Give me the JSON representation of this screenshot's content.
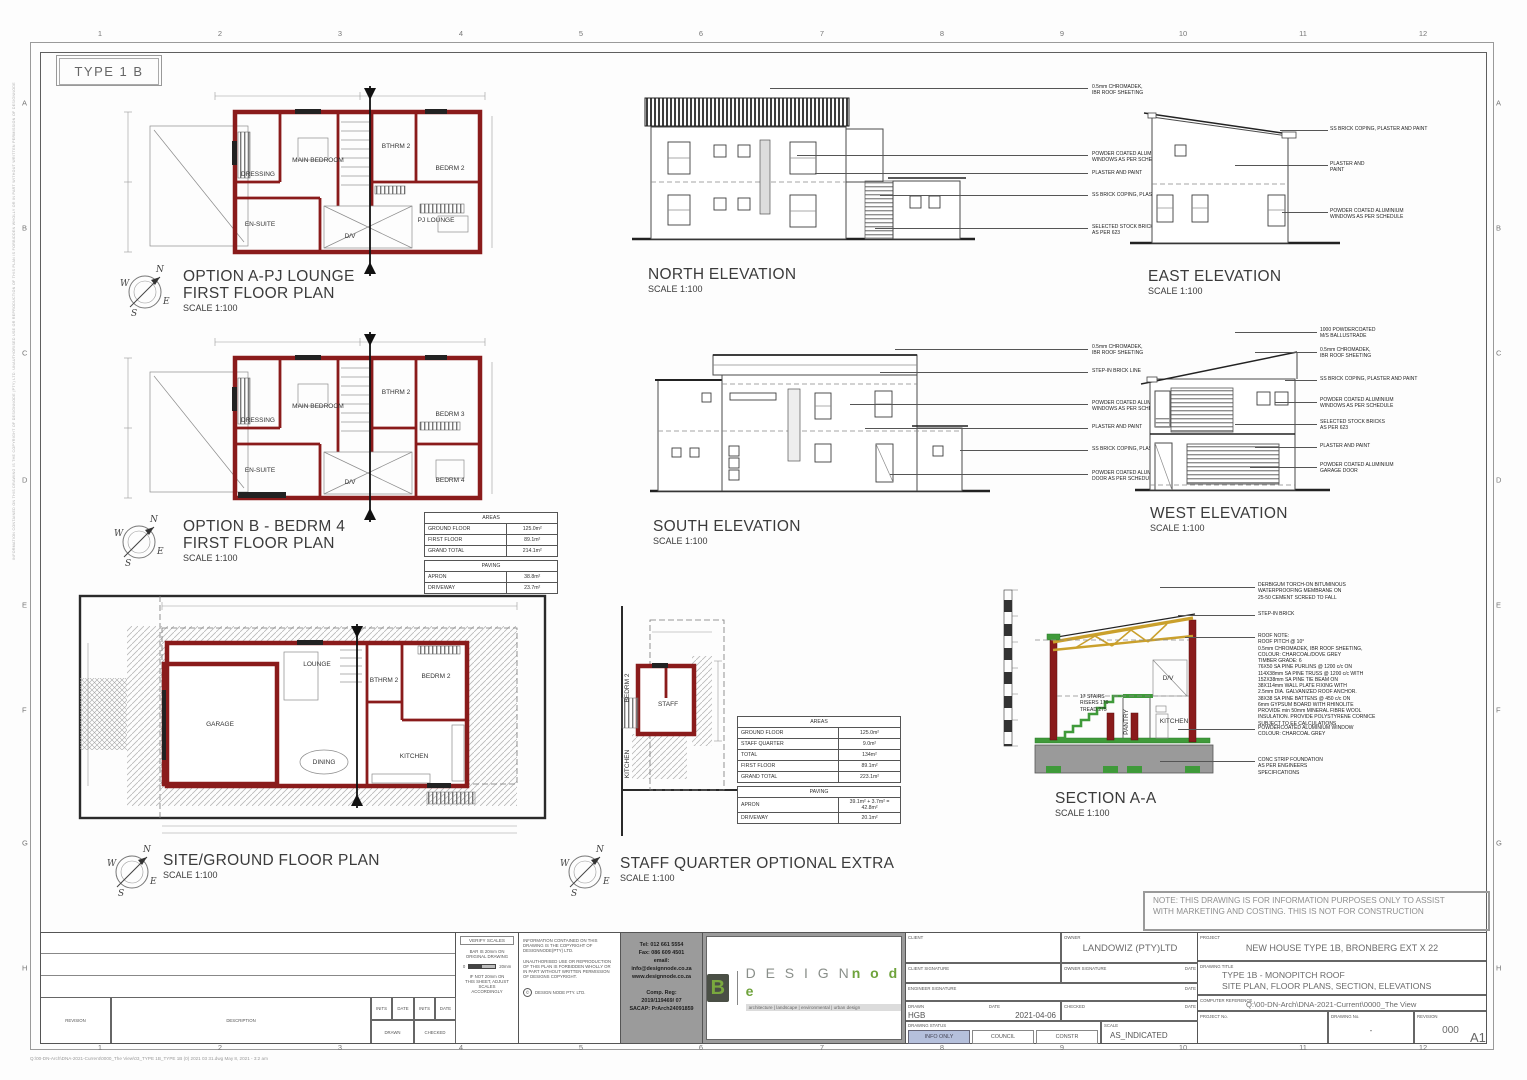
{
  "sheet": {
    "type_label": "TYPE 1 B",
    "paper_size": "A1",
    "grid_cols": [
      "1",
      "2",
      "3",
      "4",
      "5",
      "6",
      "7",
      "8",
      "9",
      "10",
      "11",
      "12"
    ],
    "grid_rows": [
      "A",
      "B",
      "C",
      "D",
      "E",
      "F",
      "G",
      "H"
    ],
    "note": "NOTE: THIS DRAWING IS FOR INFORMATION PURPOSES ONLY TO ASSIST\nWITH MARKETING AND COSTING. THIS IS NOT FOR CONSTRUCTION",
    "margin_note": "INFORMATION CONTAINED ON THIS DRAWING IS THE COPYRIGHT OF DESIGNNODE (PTY) LTD. UNAUTHORISED USE OR REPRODUCTION OF THIS PLAN IS FORBIDDEN WHOLLY OR IN PART WITHOUT WRITTEN PERMISSION OF DESIGNNODE",
    "file_ref": "Q:\\00-DN-Arch\\DNA-2021-Current\\0000_The View\\03_TYPE 1B_TYPE 1B (0) 2021 03 31.dwg  May 8, 2021 - 3:2 am"
  },
  "compass": {
    "n": "N",
    "e": "E",
    "s": "S",
    "w": "W"
  },
  "plans": {
    "option_a": {
      "title": "OPTION A-PJ LOUNGE",
      "subtitle": "FIRST FLOOR PLAN",
      "scale": "SCALE 1:100",
      "rooms": {
        "dressing": "DRESSING",
        "main_bedroom": "MAIN BEDROOM",
        "bthrm2": "BTHRM 2",
        "bedrm2": "BEDRM 2",
        "ensuite": "EN-SUITE",
        "dv": "D/V",
        "pj_lounge": "PJ LOUNGE"
      }
    },
    "option_b": {
      "title": "OPTION B - BEDRM 4",
      "subtitle": "FIRST FLOOR PLAN",
      "scale": "SCALE 1:100",
      "rooms": {
        "dressing": "DRESSING",
        "main_bedroom": "MAIN BEDROOM",
        "bthrm2": "BTHRM 2",
        "bedrm3": "BEDRM 3",
        "ensuite": "EN-SUITE",
        "dv": "D/V",
        "bedrm4": "BEDRM 4"
      }
    },
    "ground": {
      "title": "SITE/GROUND FLOOR PLAN",
      "scale": "SCALE 1:100",
      "rooms": {
        "garage": "GARAGE",
        "lounge": "LOUNGE",
        "bthrm2": "BTHRM 2",
        "bedrm2": "BEDRM 2",
        "dining": "DINING",
        "kitchen": "KITCHEN"
      }
    },
    "staff": {
      "title": "STAFF QUARTER OPTIONAL EXTRA",
      "scale": "SCALE 1:100",
      "rooms": {
        "bedrm2": "BEDRM 2",
        "staff": "STAFF",
        "kitchen": "KITCHEN"
      }
    }
  },
  "elevations": {
    "north": {
      "title": "NORTH ELEVATION",
      "scale": "SCALE 1:100",
      "callouts": [
        "0.5mm CHROMADEK,\nIBR ROOF SHEETING",
        "POWDER COATED ALUMINIUM\nWINDOWS AS PER SCHEDULE",
        "PLASTER AND PAINT",
        "SS BRICK COPING, PLASTER AND PAINT",
        "SELECTED STOCK BRICKS\nAS PER 623"
      ]
    },
    "east": {
      "title": "EAST ELEVATION",
      "scale": "SCALE 1:100",
      "callouts": [
        "SS BRICK COPING, PLASTER AND PAINT",
        "PLASTER AND\nPAINT",
        "POWDER COATED ALUMINIUM\nWINDOWS AS PER SCHEDULE"
      ]
    },
    "south": {
      "title": "SOUTH ELEVATION",
      "scale": "SCALE 1:100",
      "callouts": [
        "0.5mm CHROMADEK,\nIBR ROOF SHEETING",
        "STEP-IN BRICK LINE",
        "POWDER COATED ALUMINIUM\nWINDOWS AS PER SCHEDULE",
        "PLASTER AND PAINT",
        "SS BRICK COPING, PLASTER AND PAINT",
        "POWDER COATED ALUMINIUM\nDOOR AS PER SCHEDULE"
      ]
    },
    "west": {
      "title": "WEST ELEVATION",
      "scale": "SCALE 1:100",
      "callouts": [
        "1000 POWDERCOATED\nM/S BALLUSTRADE",
        "0.5mm CHROMADEK,\nIBR ROOF SHEETING",
        "SS BRICK COPING, PLASTER AND PAINT",
        "POWDER COATED ALUMINIUM\nWINDOWS AS PER SCHEDULE",
        "SELECTED STOCK BRICKS\nAS PER 623",
        "PLASTER AND PAINT",
        "POWDER COATED ALUMINIUM\nGARAGE DOOR"
      ]
    }
  },
  "section": {
    "title": "SECTION A-A",
    "scale": "SCALE 1:100",
    "rooms": {
      "dv": "D/V",
      "pantry": "PANTRY",
      "kitchen": "KITCHEN"
    },
    "stair_note": "17 STAIRS\nRISERS 170\nTREAD 275",
    "callouts": [
      "DERBIGUM TORCH-ON BITUMINOUS\nWATERPROOFING MEMBRANE ON\n25-50 CEMENT SCREED TO FALL",
      "STEP-IN BRICK",
      "ROOF NOTE:\nROOF PITCH @ 10°\n0.5mm CHROMADEK, IBR ROOF SHEETING,\nCOLOUR: CHARCOAL/DOVE GREY\nTIMBER GRADE: 6\n76X50 SA PINE PURLINS @ 1200 c/c ON\n114X38mm SA PINE TRUSS @ 1200 c/c WITH\n152X38mm SA PINE TIE BEAM ON\n38X114mm WALL PLATE FIXING WITH\n2.5mm DIA. GALVANIZED ROOF ANCHOR.\n38X38 SA PINE BATTENS @ 450 c/c ON\n6mm GYPSUM BOARD WITH RHINOLITE\nPROVIDE min 50mm MINERAL FIBRE WOOL\nINSULATION. PROVIDE POLYSTYRENE CORNICE\nSUBJECT TO EE CALCULATIONS",
      "POWDERCOATED ALUMINIUM WINDOW\nCOLOUR: CHARCOAL GREY",
      "CONC STRIP FOUNDATION\nAS PER ENGINEERS\nSPECIFICATIONS"
    ]
  },
  "tables": {
    "option_b_areas": {
      "title": "AREAS",
      "rows": [
        {
          "label": "GROUND FLOOR",
          "value": "125.0m²"
        },
        {
          "label": "FIRST FLOOR",
          "value": "89.1m²"
        },
        {
          "label": "GRAND TOTAL",
          "value": "214.1m²"
        }
      ],
      "paving_title": "PAVING",
      "paving_rows": [
        {
          "label": "APRON",
          "value": "38.8m²"
        },
        {
          "label": "DRIVEWAY",
          "value": "23.7m²"
        }
      ]
    },
    "staff_areas": {
      "title": "AREAS",
      "rows": [
        {
          "label": "GROUND FLOOR",
          "value": "125.0m²"
        },
        {
          "label": "STAFF QUARTER",
          "value": "9.0m²"
        },
        {
          "label": "TOTAL",
          "value": "134m²"
        },
        {
          "label": "FIRST FLOOR",
          "value": "89.1m²"
        },
        {
          "label": "GRAND TOTAL",
          "value": "223.1m²"
        }
      ],
      "paving_title": "PAVING",
      "paving_rows": [
        {
          "label": "APRON",
          "value": "39.1m² + 3.7m² = 42.8m²"
        },
        {
          "label": "DRIVEWAY",
          "value": "20.1m²"
        }
      ]
    }
  },
  "titleblock": {
    "revision_table": {
      "revision": "REVISION",
      "description": "DESCRIPTION",
      "inits1": "INITS",
      "date1": "DATE",
      "inits2": "INITS",
      "date2": "DATE",
      "drawn": "DRAWN",
      "checked": "CHECKED"
    },
    "verify": {
      "title": "VERIFY SCALES",
      "line1": "BAR IS 20mm ON\nORIGINAL DRAWING",
      "zero": "0",
      "twenty": "20mm",
      "line2": "IF NOT 20mm ON\nTHIS SHEET, ADJUST\nSCALES\nACCORDINGLY"
    },
    "copyright": {
      "p1": "INFORMATION CONTAINED ON THIS\nDRAWING IS THE COPYRIGHT OF\nDESIGNNODE(PTY) LTD.",
      "p2": "UNAUTHORISED USE OR REPRODUCTION\nOF THIS PLAN IS FORBIDDEN WHOLLY OR\nIN PART WITHOUT WRITTEN PERMISSION\nOF DESIGNS COPYRIGHT.",
      "c": "©",
      "p3": "DESIGN NODE PTY. LTD."
    },
    "contact": {
      "tel": "Tel:  012  661  5554",
      "fax": "Fax:  086  609  4501",
      "email_label": "email:",
      "email": "info@designnode.co.za",
      "web": "www.designnode.co.za",
      "reg_label": "Comp. Reg:",
      "reg": "2019/119469/ 07",
      "sacap": "SACAP: PrArch24091859"
    },
    "logo": {
      "mark": "B",
      "design": "D E S I G N",
      "node": "n o d e",
      "tagline": "architecture  |  landscape  |  environmental  |  urban design"
    },
    "client_block": {
      "client_label": "CLIENT",
      "owner_label": "OWNER",
      "owner": "LANDOWIZ (PTY)LTD",
      "client_sig_label": "CLIENT SIGNATURE",
      "owner_sig_label": "OWNER SIGNATURE",
      "date_label": "DATE",
      "engineer_sig_label": "ENGINEER SIGNATURE",
      "drawn_label": "DRAWN",
      "drawn": "HGB",
      "date_value": "2021-04-06",
      "checked_label": "CHECKED",
      "status_label": "DRAWING STATUS",
      "status_options": [
        "INFO ONLY",
        "COUNCIL",
        "CONSTR"
      ],
      "scale_label": "SCALE",
      "scale": "AS_INDICATED"
    },
    "project_block": {
      "project_label": "PROJECT",
      "project": "NEW HOUSE TYPE 1B, BRONBERG EXT X 22",
      "drawing_title_label": "DRAWING TITLE",
      "drawing_title1": "TYPE 1B - MONOPITCH ROOF",
      "drawing_title2": "SITE PLAN, FLOOR PLANS, SECTION, ELEVATIONS",
      "ref_label": "COMPUTER REFERENCE",
      "ref": "Q:\\00-DN-Arch\\DNA-2021-Current\\0000_The View",
      "project_no_label": "PROJECT No.",
      "drawing_no_label": "DRAWING No.",
      "drawing_no": "-",
      "revision_label": "REVISION",
      "revision": "000"
    }
  }
}
